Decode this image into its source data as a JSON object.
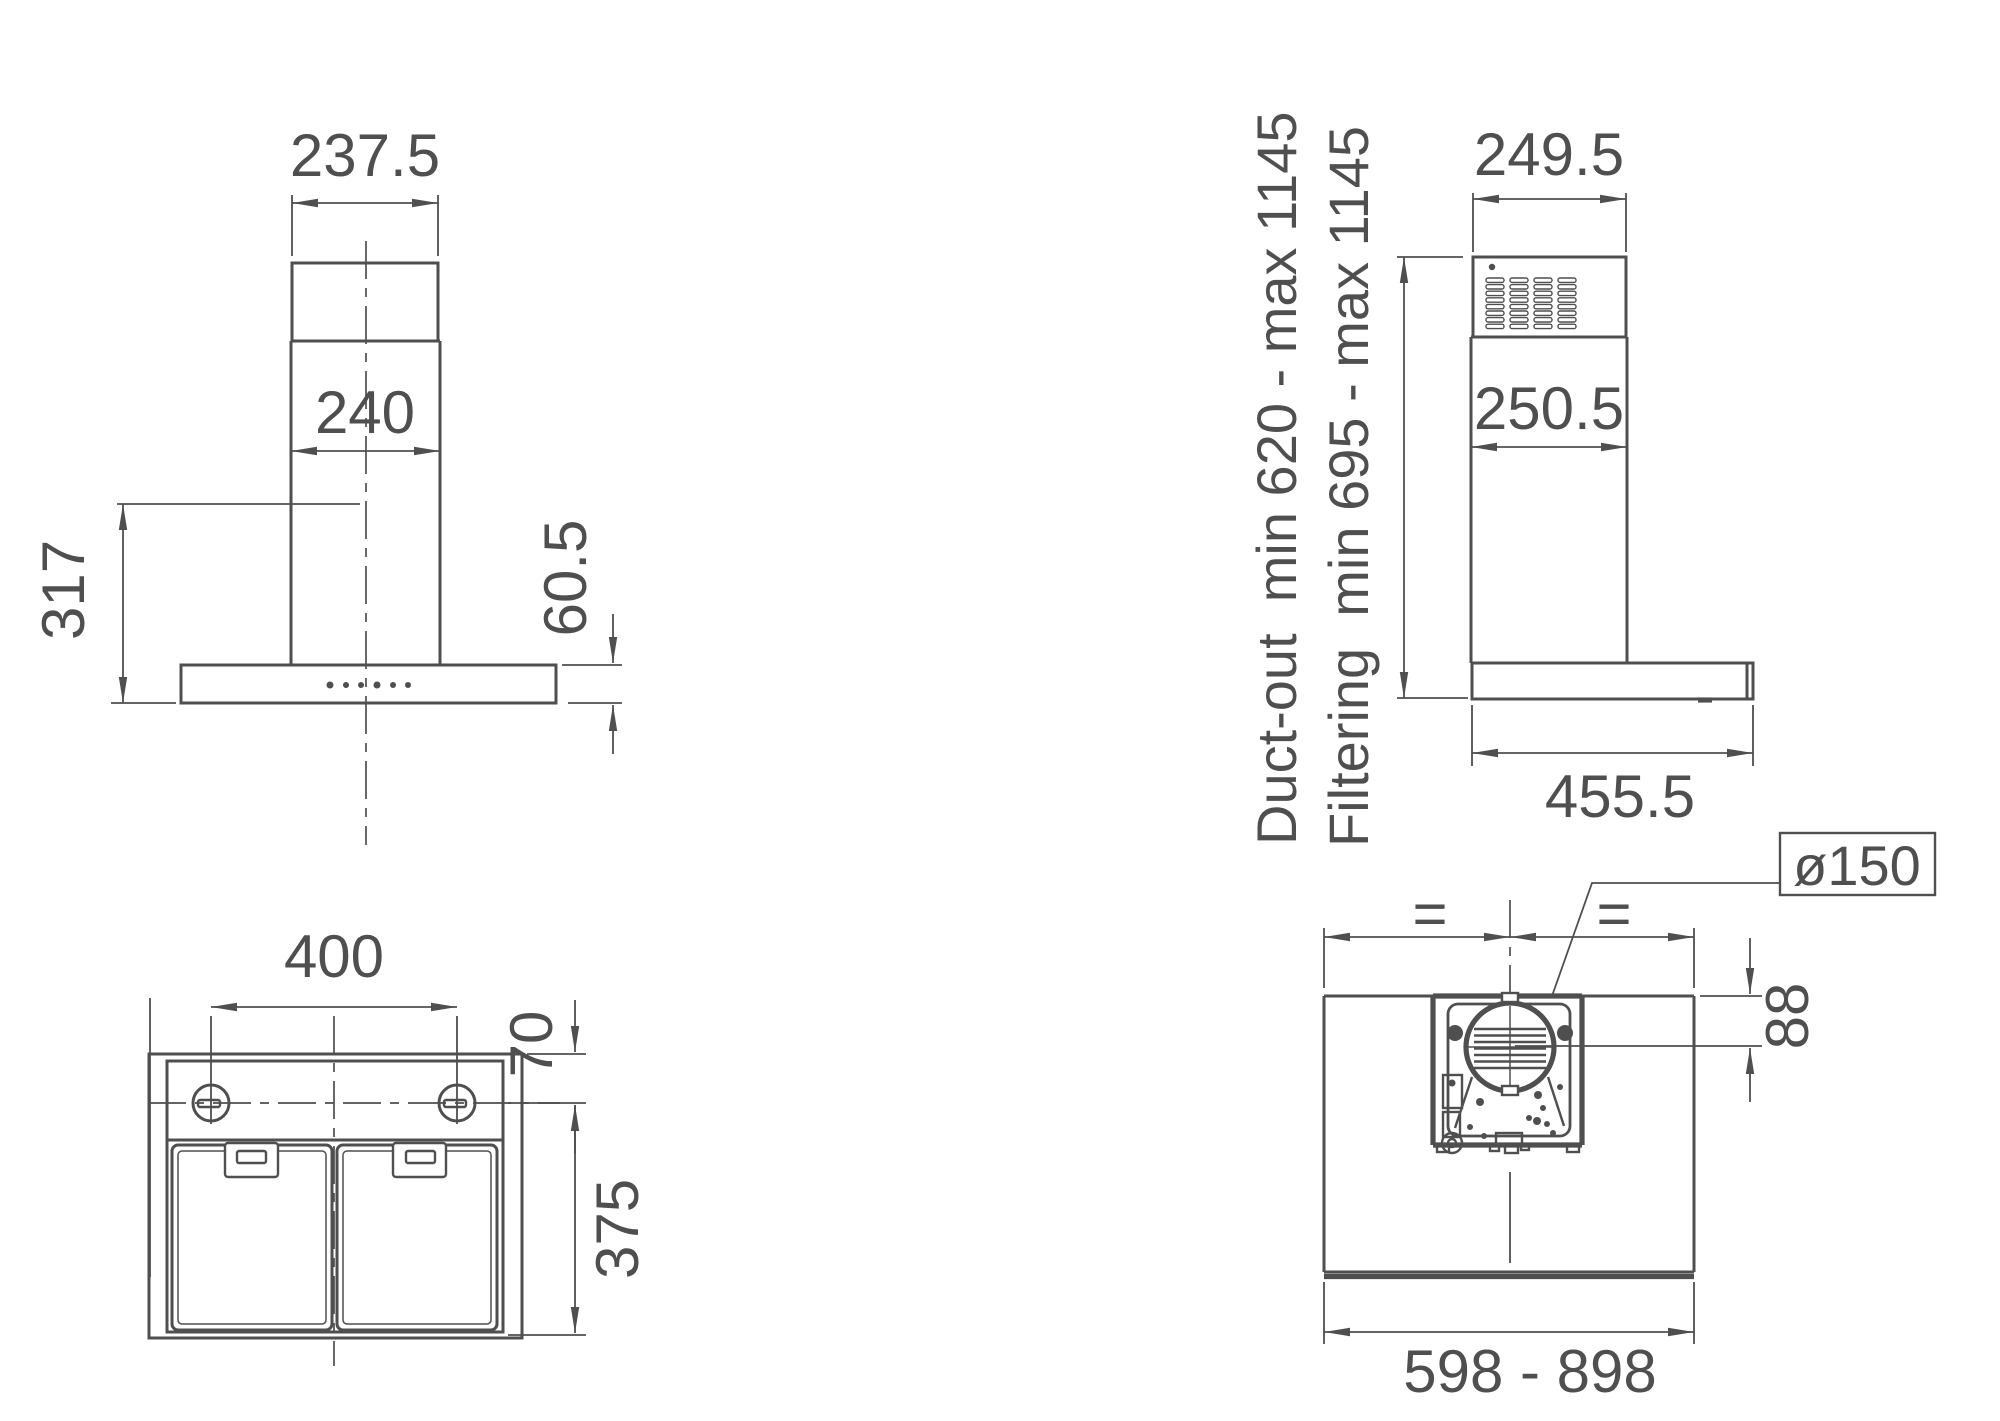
{
  "drawing_type": "cooker-hood installation dimensions",
  "colors": {
    "line": "#4f4f4f",
    "background": "#ffffff"
  },
  "views": {
    "front": {
      "dim_top_width": "237.5",
      "dim_chimney_width": "240",
      "dim_height": "317",
      "dim_body_height": "60.5"
    },
    "side": {
      "dim_top_depth": "249.5",
      "dim_chimney_depth": "250.5",
      "dim_body_depth": "455.5",
      "label_duct_out": "Duct-out  min 620 - max 1145",
      "label_filtering": "Filtering  min 695 - max 1145"
    },
    "bottom": {
      "dim_lamp_spacing": "400",
      "dim_top_offset": "70",
      "dim_depth": "375"
    },
    "top": {
      "label_duct_diameter": "ø150",
      "dim_duct_offset": "88",
      "dim_width_range": "598 - 898",
      "equal_left": "=",
      "equal_right": "="
    }
  }
}
